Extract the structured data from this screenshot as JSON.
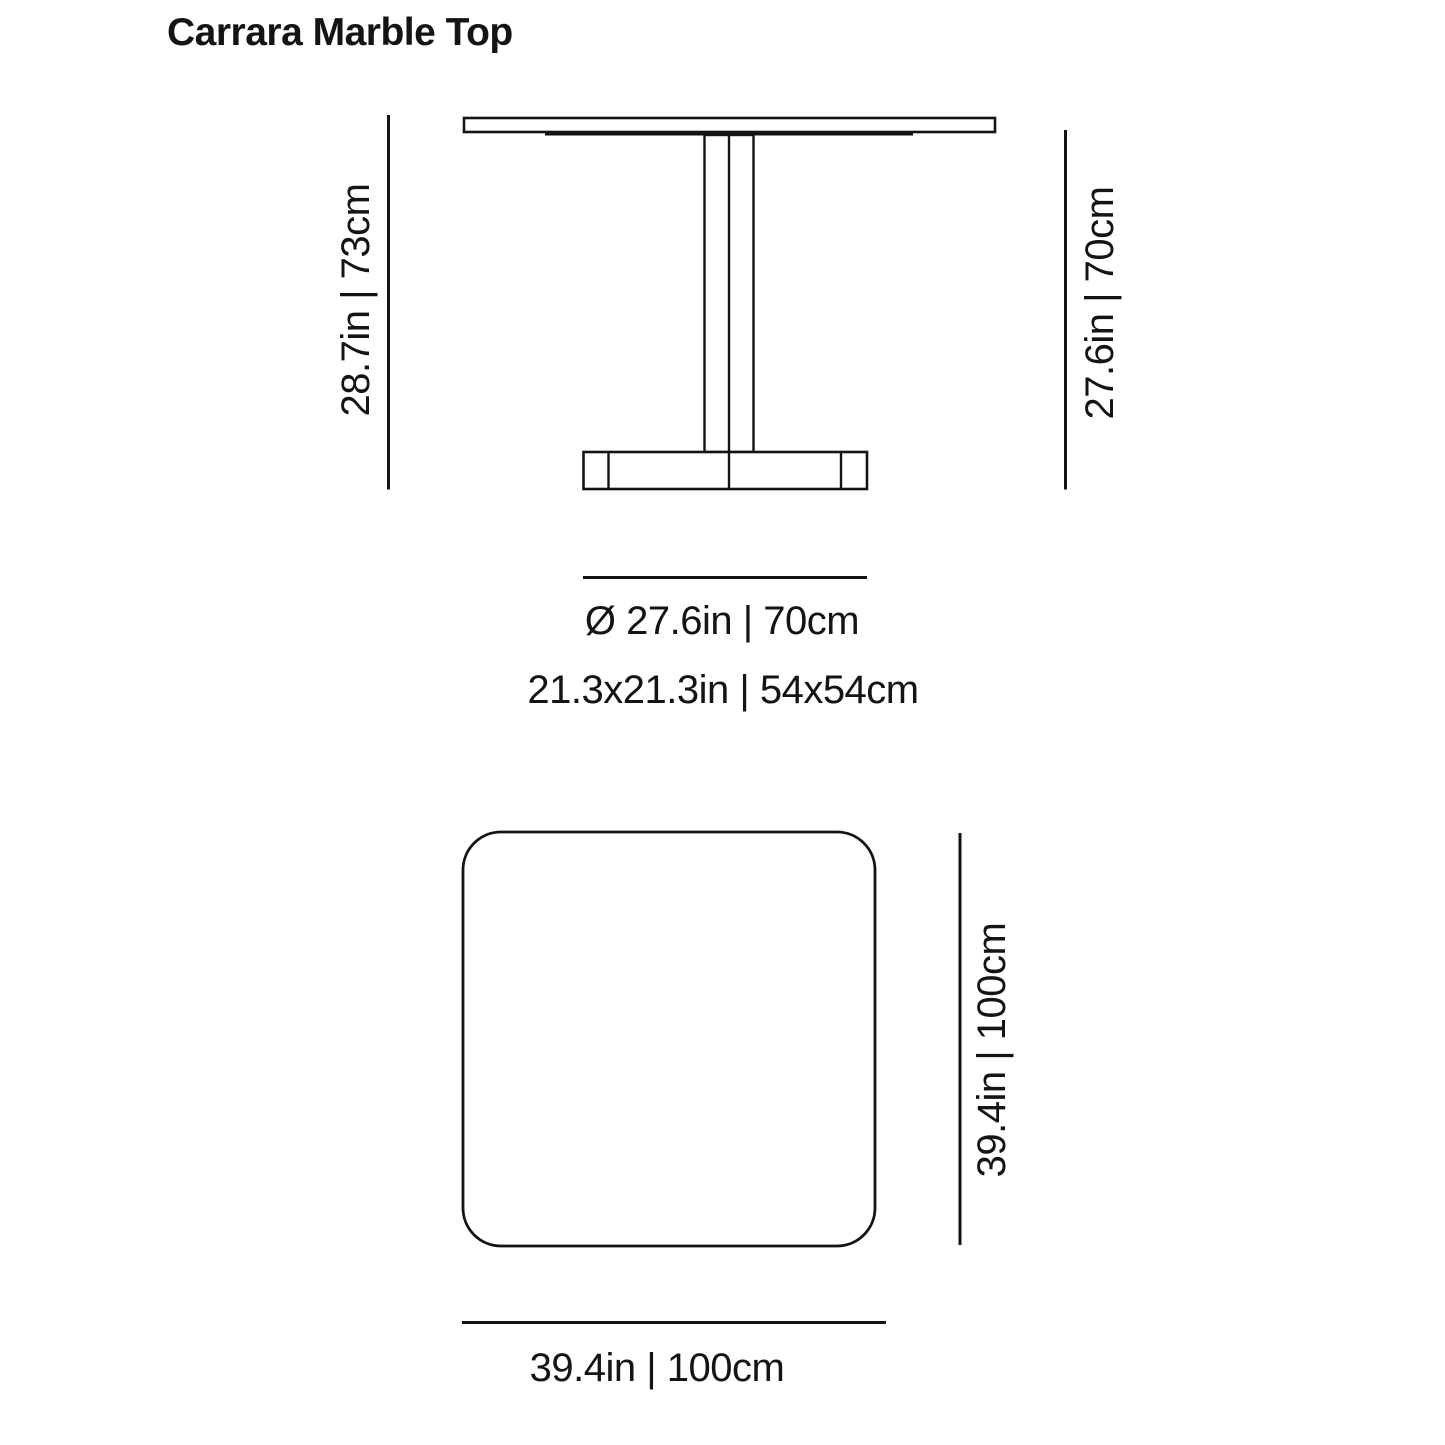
{
  "title": "Carrara Marble Top",
  "colors": {
    "ink": "#141414",
    "background": "#ffffff"
  },
  "elevation_view": {
    "label_height_total": "28.7in | 73cm",
    "label_height_underside": "27.6in | 70cm",
    "label_top_diameter": "Ø 27.6in | 70cm",
    "label_base_footprint": "21.3x21.3in | 54x54cm"
  },
  "top_view": {
    "label_side": "39.4in | 100cm",
    "label_width": "39.4in | 100cm"
  }
}
